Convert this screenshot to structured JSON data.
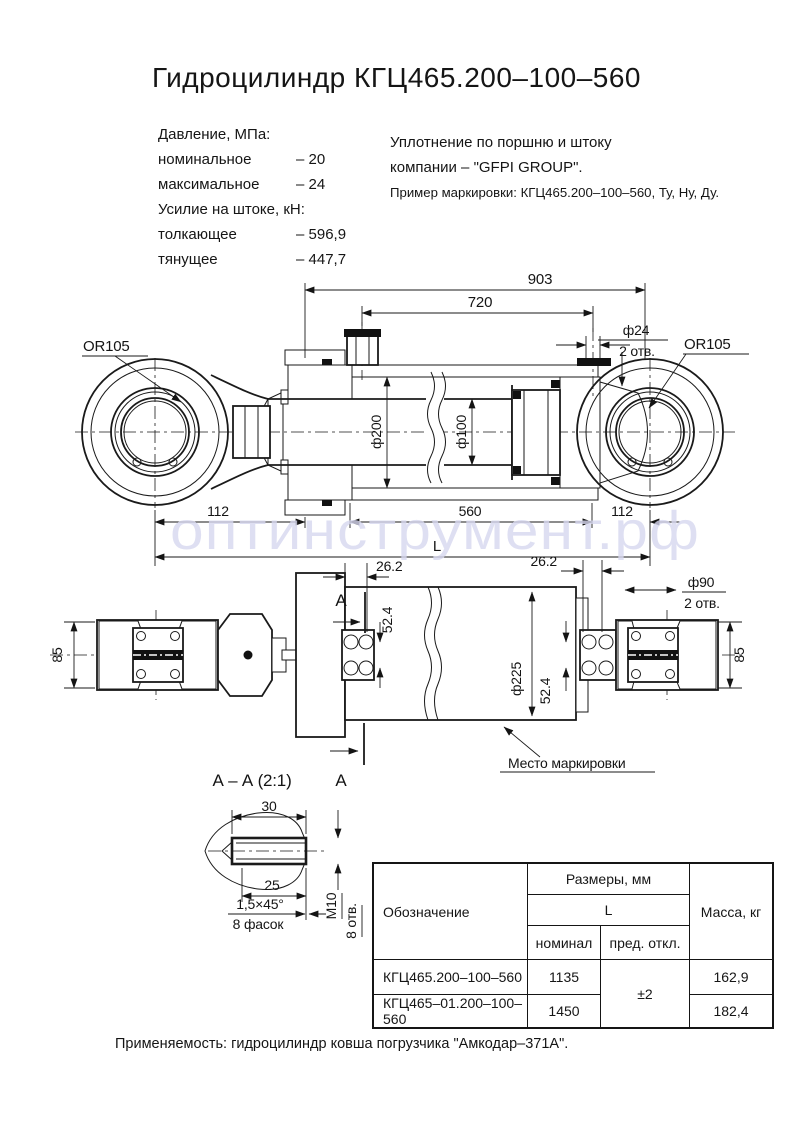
{
  "title": "Гидроцилиндр КГЦ465.200–100–560",
  "watermark": "оптинструмент.рф",
  "specs": {
    "pressure_header": "Давление, МПа:",
    "pressure_rows": [
      {
        "label": "номинальное",
        "value": "– 20"
      },
      {
        "label": "максимальное",
        "value": "– 24"
      }
    ],
    "force_header": "Усилие на штоке, кН:",
    "force_rows": [
      {
        "label": "толкающее",
        "value": "– 596,9"
      },
      {
        "label": "тянущее",
        "value": "– 447,7"
      }
    ]
  },
  "seal_note": {
    "line1": "Уплотнение по поршню и штоку",
    "line2": "компании – \"GFPI GROUP\".",
    "line3": "Пример маркировки: КГЦ465.200–100–560, Ту, Ну, Ду."
  },
  "view1": {
    "eye_left": "OR105",
    "eye_right": "OR105",
    "dim_overall": "903",
    "dim_ports": "720",
    "dim_port_dia": "ф24",
    "dim_port_holes": "2 отв.",
    "dim_bore": "ф200",
    "dim_rod": "ф100",
    "dim_left": "112",
    "dim_stroke": "560",
    "dim_length": "L",
    "dim_right": "112"
  },
  "view2": {
    "dim_eye_left": "85",
    "dim_eye_right": "85",
    "dim_offset_left": "26.2",
    "dim_offset_right": "26.2",
    "dim_hole_dia": "ф90",
    "dim_hole_count": "2 отв.",
    "dim_spacing_left": "52.4",
    "dim_spacing_right": "52.4",
    "dim_body": "ф225",
    "marking_label": "Место маркировки",
    "section_letter": "А"
  },
  "detail": {
    "title": "А – А (2:1)",
    "dim_length": "30",
    "dim_thread_depth": "25",
    "chamfer": "1,5×45°",
    "chamfer_count": "8 фасок",
    "thread": "М10",
    "thread_count": "8 отв."
  },
  "table": {
    "header_designation": "Обозначение",
    "header_sizes": "Размеры, мм",
    "header_L": "L",
    "header_nominal": "номинал",
    "header_tolerance": "пред. откл.",
    "header_mass": "Масса, кг",
    "tolerance": "±2",
    "rows": [
      {
        "designation": "КГЦ465.200–100–560",
        "nominal": "1135",
        "mass": "162,9"
      },
      {
        "designation": "КГЦ465–01.200–100–560",
        "nominal": "1450",
        "mass": "182,4"
      }
    ]
  },
  "footer": {
    "application": "Применяемость:  гидроцилиндр ковша погрузчика \"Амкодар–371А\"."
  }
}
